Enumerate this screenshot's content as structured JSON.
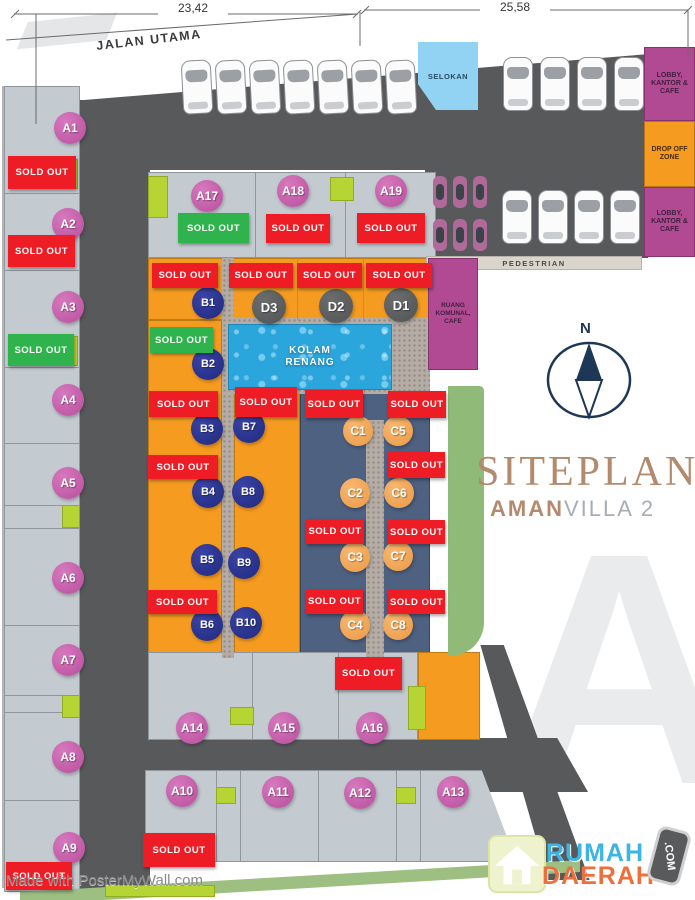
{
  "dimensions": {
    "left": "23,42",
    "right": "25,58"
  },
  "roads": {
    "main": "JALAN UTAMA",
    "pedestrian": "PEDESTRIAN",
    "drain": "SELOKAN"
  },
  "facilities": {
    "lobby_top": "LOBBY, KANTOR & CAFE",
    "drop_off": "DROP OFF ZONE",
    "lobby_bottom": "LOBBY, KANTOR & CAFE",
    "pool_line1": "KOLAM",
    "pool_line2": "RENANG",
    "communal_line1": "RUANG",
    "communal_line2": "KOMUNAL, CAFE"
  },
  "compass": {
    "label": "N"
  },
  "titles": {
    "siteplan": "SITEPLAN",
    "brand_bold": "AMAN",
    "brand_light": "VILLA 2",
    "watermark_letter": "A"
  },
  "logo": {
    "word_top": "RUMAH",
    "word_bottom": "DAERAH",
    "badge": ".COM"
  },
  "credit": "Made with PosterMyWall.com",
  "sold_out_label": "SOLD OUT",
  "colors": {
    "road": "#58595b",
    "lot_gray": "#c3cad0",
    "lot_orange": "#f59b20",
    "lot_slate": "#4e6181",
    "sold_red": "#ee1c25",
    "sold_green": "#2fb34c",
    "lime": "#b6d433",
    "magenta": "#b14a92",
    "selokan_blue": "#92d3f3",
    "pool_blue": "#2aa6dd",
    "badge_pink": "#c760ad",
    "badge_navy": "#2b3490",
    "badge_orange": "#f2a65a",
    "badge_gray": "#5a5c5e",
    "title_tan": "#b38a6d",
    "logo_blue": "#3cb4e7",
    "logo_orange": "#ef6f3c",
    "green_strip": "#8fba77"
  },
  "lot_badges": [
    {
      "label": "A1",
      "type": "a",
      "x": 70,
      "y": 128
    },
    {
      "label": "A2",
      "type": "a",
      "x": 68,
      "y": 224
    },
    {
      "label": "A3",
      "type": "a",
      "x": 68,
      "y": 307
    },
    {
      "label": "A4",
      "type": "a",
      "x": 68,
      "y": 400
    },
    {
      "label": "A5",
      "type": "a",
      "x": 68,
      "y": 483
    },
    {
      "label": "A6",
      "type": "a",
      "x": 68,
      "y": 578
    },
    {
      "label": "A7",
      "type": "a",
      "x": 68,
      "y": 660
    },
    {
      "label": "A8",
      "type": "a",
      "x": 68,
      "y": 757
    },
    {
      "label": "A9",
      "type": "a",
      "x": 69,
      "y": 848
    },
    {
      "label": "A17",
      "type": "a",
      "x": 207,
      "y": 196
    },
    {
      "label": "A18",
      "type": "a",
      "x": 293,
      "y": 191
    },
    {
      "label": "A19",
      "type": "a",
      "x": 391,
      "y": 191
    },
    {
      "label": "A14",
      "type": "a",
      "x": 192,
      "y": 728
    },
    {
      "label": "A15",
      "type": "a",
      "x": 284,
      "y": 728
    },
    {
      "label": "A16",
      "type": "a",
      "x": 372,
      "y": 728
    },
    {
      "label": "A10",
      "type": "a",
      "x": 182,
      "y": 791
    },
    {
      "label": "A11",
      "type": "a",
      "x": 278,
      "y": 792
    },
    {
      "label": "A12",
      "type": "a",
      "x": 360,
      "y": 793
    },
    {
      "label": "A13",
      "type": "a",
      "x": 453,
      "y": 792
    },
    {
      "label": "B1",
      "type": "b",
      "x": 208,
      "y": 303
    },
    {
      "label": "B2",
      "type": "b",
      "x": 208,
      "y": 364
    },
    {
      "label": "B3",
      "type": "b",
      "x": 207,
      "y": 429
    },
    {
      "label": "B7",
      "type": "b",
      "x": 249,
      "y": 427
    },
    {
      "label": "B4",
      "type": "b",
      "x": 208,
      "y": 492
    },
    {
      "label": "B8",
      "type": "b",
      "x": 248,
      "y": 492
    },
    {
      "label": "B5",
      "type": "b",
      "x": 207,
      "y": 560
    },
    {
      "label": "B9",
      "type": "b",
      "x": 244,
      "y": 563
    },
    {
      "label": "B6",
      "type": "b",
      "x": 207,
      "y": 625
    },
    {
      "label": "B10",
      "type": "b",
      "x": 246,
      "y": 623
    },
    {
      "label": "C1",
      "type": "c",
      "x": 358,
      "y": 431
    },
    {
      "label": "C5",
      "type": "c",
      "x": 398,
      "y": 431
    },
    {
      "label": "C2",
      "type": "c",
      "x": 355,
      "y": 493
    },
    {
      "label": "C6",
      "type": "c",
      "x": 399,
      "y": 493
    },
    {
      "label": "C3",
      "type": "c",
      "x": 355,
      "y": 557
    },
    {
      "label": "C7",
      "type": "c",
      "x": 398,
      "y": 556
    },
    {
      "label": "C4",
      "type": "c",
      "x": 355,
      "y": 625
    },
    {
      "label": "C8",
      "type": "c",
      "x": 398,
      "y": 625
    },
    {
      "label": "D3",
      "type": "d",
      "x": 269,
      "y": 307
    },
    {
      "label": "D2",
      "type": "d",
      "x": 336,
      "y": 306
    },
    {
      "label": "D1",
      "type": "d",
      "x": 401,
      "y": 305
    }
  ],
  "sold_markers": [
    {
      "x": 8,
      "y": 156,
      "w": 68,
      "h": 33,
      "status": "red"
    },
    {
      "x": 8,
      "y": 235,
      "w": 67,
      "h": 32,
      "status": "red"
    },
    {
      "x": 8,
      "y": 334,
      "w": 66,
      "h": 32,
      "status": "green"
    },
    {
      "x": 6,
      "y": 862,
      "w": 66,
      "h": 28,
      "status": "red"
    },
    {
      "x": 178,
      "y": 213,
      "w": 71,
      "h": 30,
      "status": "green"
    },
    {
      "x": 266,
      "y": 214,
      "w": 64,
      "h": 29,
      "status": "red"
    },
    {
      "x": 357,
      "y": 213,
      "w": 68,
      "h": 30,
      "status": "red"
    },
    {
      "x": 152,
      "y": 263,
      "w": 66,
      "h": 25,
      "status": "red"
    },
    {
      "x": 229,
      "y": 263,
      "w": 64,
      "h": 25,
      "status": "red"
    },
    {
      "x": 297,
      "y": 263,
      "w": 65,
      "h": 25,
      "status": "red"
    },
    {
      "x": 366,
      "y": 263,
      "w": 66,
      "h": 25,
      "status": "red"
    },
    {
      "x": 150,
      "y": 327,
      "w": 63,
      "h": 26,
      "status": "green"
    },
    {
      "x": 149,
      "y": 391,
      "w": 69,
      "h": 26,
      "status": "red"
    },
    {
      "x": 235,
      "y": 387,
      "w": 62,
      "h": 30,
      "status": "red"
    },
    {
      "x": 305,
      "y": 390,
      "w": 58,
      "h": 28,
      "status": "red"
    },
    {
      "x": 388,
      "y": 391,
      "w": 58,
      "h": 27,
      "status": "red"
    },
    {
      "x": 148,
      "y": 455,
      "w": 70,
      "h": 24,
      "status": "red"
    },
    {
      "x": 388,
      "y": 452,
      "w": 57,
      "h": 26,
      "status": "red"
    },
    {
      "x": 306,
      "y": 519,
      "w": 58,
      "h": 25,
      "status": "red"
    },
    {
      "x": 388,
      "y": 520,
      "w": 57,
      "h": 24,
      "status": "red"
    },
    {
      "x": 148,
      "y": 590,
      "w": 69,
      "h": 24,
      "status": "red"
    },
    {
      "x": 306,
      "y": 589,
      "w": 57,
      "h": 25,
      "status": "red"
    },
    {
      "x": 388,
      "y": 590,
      "w": 57,
      "h": 24,
      "status": "red"
    },
    {
      "x": 335,
      "y": 657,
      "w": 67,
      "h": 33,
      "status": "red"
    },
    {
      "x": 143,
      "y": 833,
      "w": 72,
      "h": 34,
      "status": "red"
    }
  ]
}
